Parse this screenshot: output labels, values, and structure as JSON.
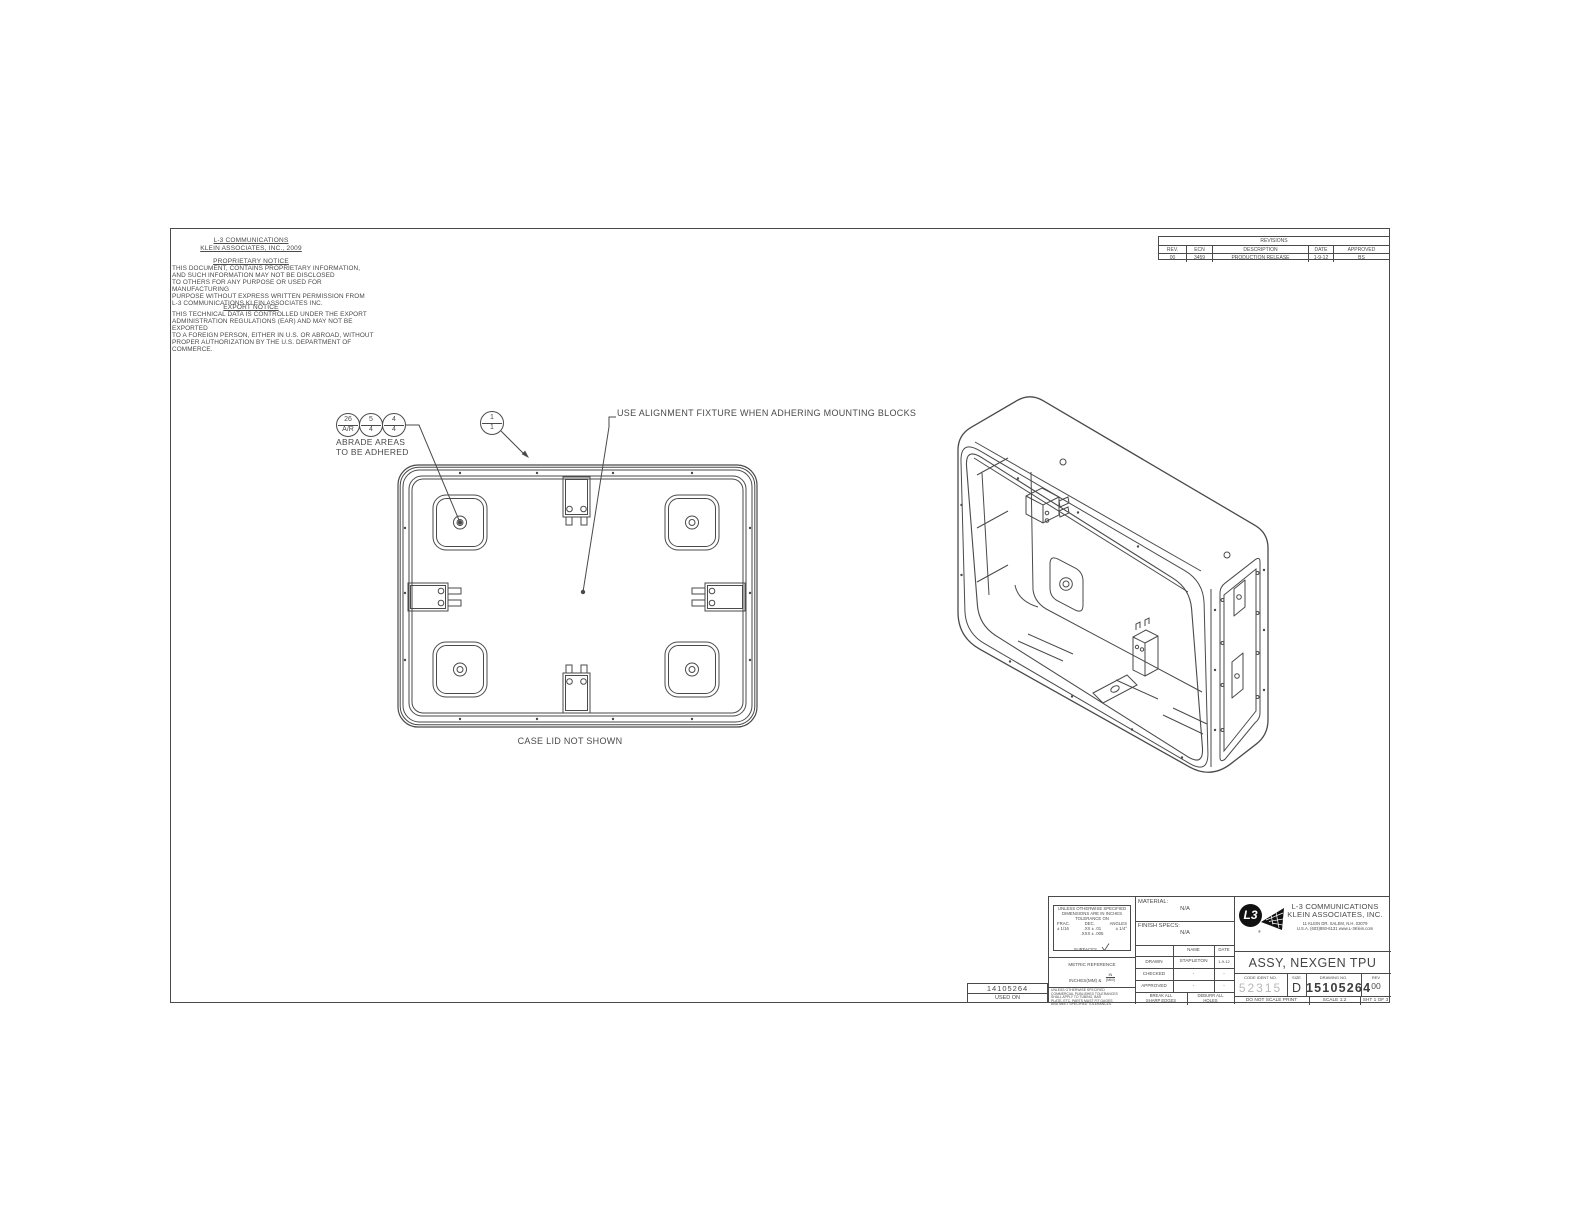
{
  "notices": {
    "company_line1": "L-3 COMMUNICATIONS",
    "company_line2": "KLEIN ASSOCIATES, INC., 2009",
    "proprietary_heading": "PROPRIETARY NOTICE",
    "proprietary_body": "THIS DOCUMENT, CONTAINS PROPRIETARY INFORMATION,\nAND SUCH INFORMATION MAY NOT BE DISCLOSED\nTO OTHERS FOR ANY PURPOSE OR USED FOR MANUFACTURING\nPURPOSE WITHOUT EXPRESS WRITTEN PERMISSION FROM\nL-3 COMMUNICATIONS KLEIN ASSOCIATES INC.",
    "export_heading": "EXPORT NOTICE",
    "export_body": "THIS TECHNICAL DATA IS CONTROLLED UNDER THE EXPORT\nADMINISTRATION REGULATIONS (EAR) AND MAY NOT BE EXPORTED\nTO A FOREIGN PERSON, EITHER IN U.S. OR ABROAD, WITHOUT\nPROPER AUTHORIZATION BY THE U.S. DEPARTMENT OF COMMERCE."
  },
  "revisions": {
    "title": "REVISIONS",
    "headers": [
      "REV.",
      "ECN",
      "DESCRIPTION",
      "DATE",
      "APPROVED"
    ],
    "rows": [
      [
        "00",
        "3459",
        "PRODUCTION RELEASE",
        "1-9-12",
        "BS"
      ]
    ]
  },
  "callouts": {
    "balloons": [
      {
        "top": "26",
        "bottom": "A/R"
      },
      {
        "top": "5",
        "bottom": "4"
      },
      {
        "top": "4",
        "bottom": "4"
      }
    ],
    "item_balloon": {
      "top": "1",
      "bottom": "1"
    },
    "abrade_note": "ABRADE AREAS\nTO BE ADHERED",
    "alignment_note": "USE ALIGNMENT FIXTURE WHEN ADHERING MOUNTING BLOCKS",
    "case_lid_note": "CASE LID NOT SHOWN"
  },
  "application": {
    "part_number": "14105264",
    "used_on_label": "USED ON"
  },
  "title_block": {
    "tolerances": {
      "header": "UNLESS OTHERWISE SPECIFIED\nDIMENSIONS ARE IN INCHES\nTOLERANCE ON",
      "frac_label": "FRAC.",
      "dec_label": "DEC.",
      "angles_label": "ANGLES",
      "frac_value": "± 1/16",
      "dec_value_xx": ".XX ± .01",
      "dec_value_xxx": ".XXX ± .005",
      "angles_value": "± 1/4°",
      "surfaces_label": "SURFACES"
    },
    "metric_reference": {
      "line1": "METRIC REFERENCE",
      "line2": "INCHES(MM)  &",
      "frac_top": "IN",
      "frac_bottom": "(MM)"
    },
    "commercial_note": "UNLESS OTHERWISE SPECIFIED\nCOMMERCIAL PUBLISHED TOLERANCES\nSHALL APPLY TO TUBING, BAR\nPLATE, ETC. PARTS MUST FIT GAGES\nAND MEET SPECIFIED TOLERANCES.",
    "material_label": "MATERIAL:",
    "material_value": "N/A",
    "finish_label": "FINISH SPECS:",
    "finish_value": "N/A",
    "signoff": {
      "name_header": "NAME",
      "date_header": "DATE",
      "rows": [
        {
          "label": "DRAWN",
          "name": "STAPLETON",
          "date": "1-9-12"
        },
        {
          "label": "CHECKED",
          "name": "-",
          "date": "-"
        },
        {
          "label": "APPROVED",
          "name": "-",
          "date": "-"
        }
      ]
    },
    "break_note": "BREAK ALL\nSHARP EDGES",
    "deburr_note": "DEBURR ALL\nHOLES",
    "company": {
      "logo_text": "L3",
      "registered_mark": "®",
      "name_line1": "L-3 COMMUNICATIONS",
      "name_line2": "KLEIN ASSOCIATES, INC.",
      "address_line1": "11 KLEIN DR.  SALEM, N.H.  03079",
      "address_line2": "U.S.A.    (603)893-6131  www.L-3Klein.com"
    },
    "drawing_title": "ASSY, NEXGEN TPU",
    "code_ident_label": "CODE IDENT NO.",
    "code_ident_value": "52315",
    "size_label": "SIZE",
    "size_value": "D",
    "drawing_no_label": "DRAWING NO.",
    "drawing_no_value": "15105264",
    "rev_label": "REV",
    "rev_value": "00",
    "do_not_scale_note": "DO NOT SCALE PRINT",
    "scale_note": "SCALE 1:2",
    "sheet_note": "SHT 1 OF 3"
  }
}
